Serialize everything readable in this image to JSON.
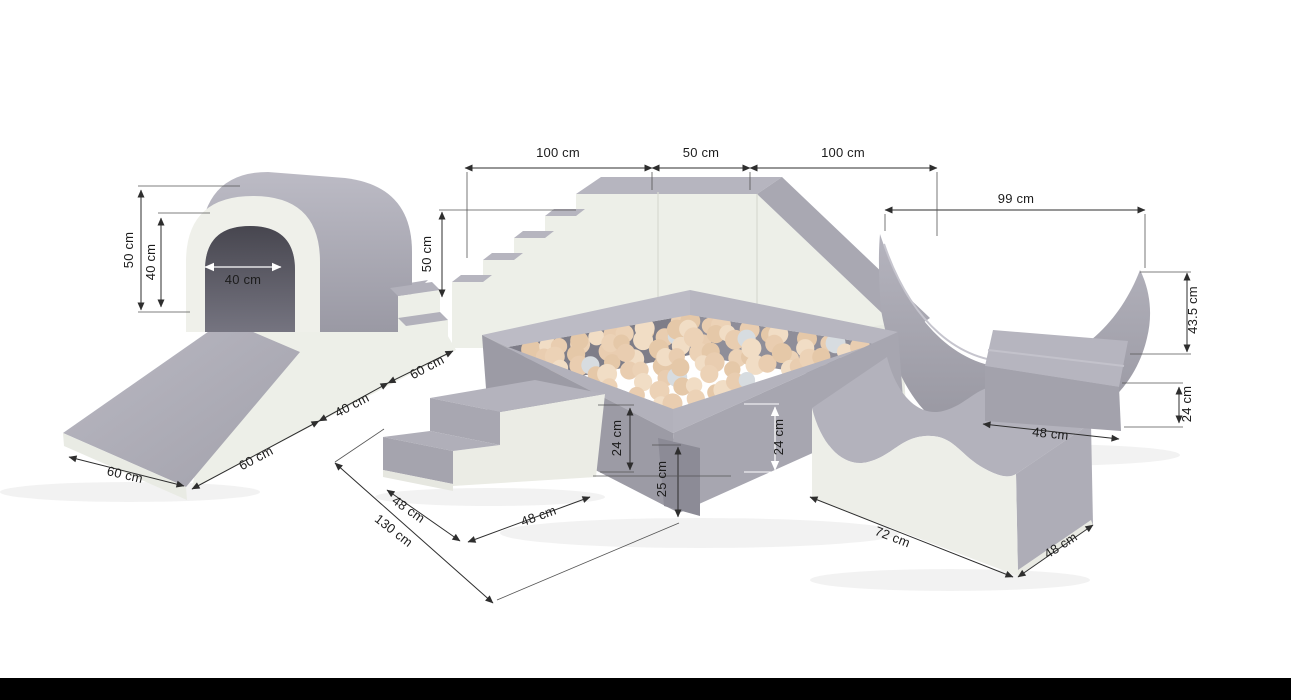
{
  "palette": {
    "background": "#ffffff",
    "foam_gray": "#a5a4ae",
    "foam_gray_light": "#b7b6c0",
    "foam_gray_dark": "#8c8b96",
    "foam_cream": "#edefe8",
    "foam_cream_shadow": "#e2e4dd",
    "pit_inner_dark": "#7e7d88",
    "tunnel_interior": "#4b4a54",
    "ball_colors": [
      "#ecd2b6",
      "#e5c8a8",
      "#f1ddc5",
      "#e9cdb0"
    ],
    "ball_silver": "#d7dce0",
    "dimension_line": "#2e2e2e",
    "label_text": "#1c1c1c",
    "label_text_light": "#ffffff",
    "footer_bar": "#000000"
  },
  "footer": {
    "bar_color": "#000000"
  },
  "dims": [
    {
      "id": "top-stairs-width",
      "label": "100 cm"
    },
    {
      "id": "top-platform-width",
      "label": "50 cm"
    },
    {
      "id": "top-slide-width",
      "label": "100 cm"
    },
    {
      "id": "rocker-width",
      "label": "99 cm"
    },
    {
      "id": "tunnel-outer-height",
      "label": "50 cm"
    },
    {
      "id": "tunnel-inner-height",
      "label": "40 cm"
    },
    {
      "id": "tunnel-opening-width",
      "label": "40 cm"
    },
    {
      "id": "staircase-height",
      "label": "50 cm"
    },
    {
      "id": "ramp-width",
      "label": "60 cm"
    },
    {
      "id": "ramp-length",
      "label": "60 cm"
    },
    {
      "id": "bridge-width",
      "label": "40 cm"
    },
    {
      "id": "step-width",
      "label": "60 cm"
    },
    {
      "id": "rocker-height",
      "label": "43.5 cm"
    },
    {
      "id": "wedge-height",
      "label": "24 cm"
    },
    {
      "id": "wedge-width",
      "label": "48 cm"
    },
    {
      "id": "pit-wall-height-left",
      "label": "24 cm"
    },
    {
      "id": "pit-outer-height",
      "label": "25 cm"
    },
    {
      "id": "pit-wall-height-right",
      "label": "24 cm"
    },
    {
      "id": "mini-stairs-depth",
      "label": "48 cm"
    },
    {
      "id": "mini-stairs-width",
      "label": "48 cm"
    },
    {
      "id": "layout-length",
      "label": "130 cm"
    },
    {
      "id": "wave-length",
      "label": "72 cm"
    },
    {
      "id": "wave-depth",
      "label": "48 cm"
    }
  ]
}
